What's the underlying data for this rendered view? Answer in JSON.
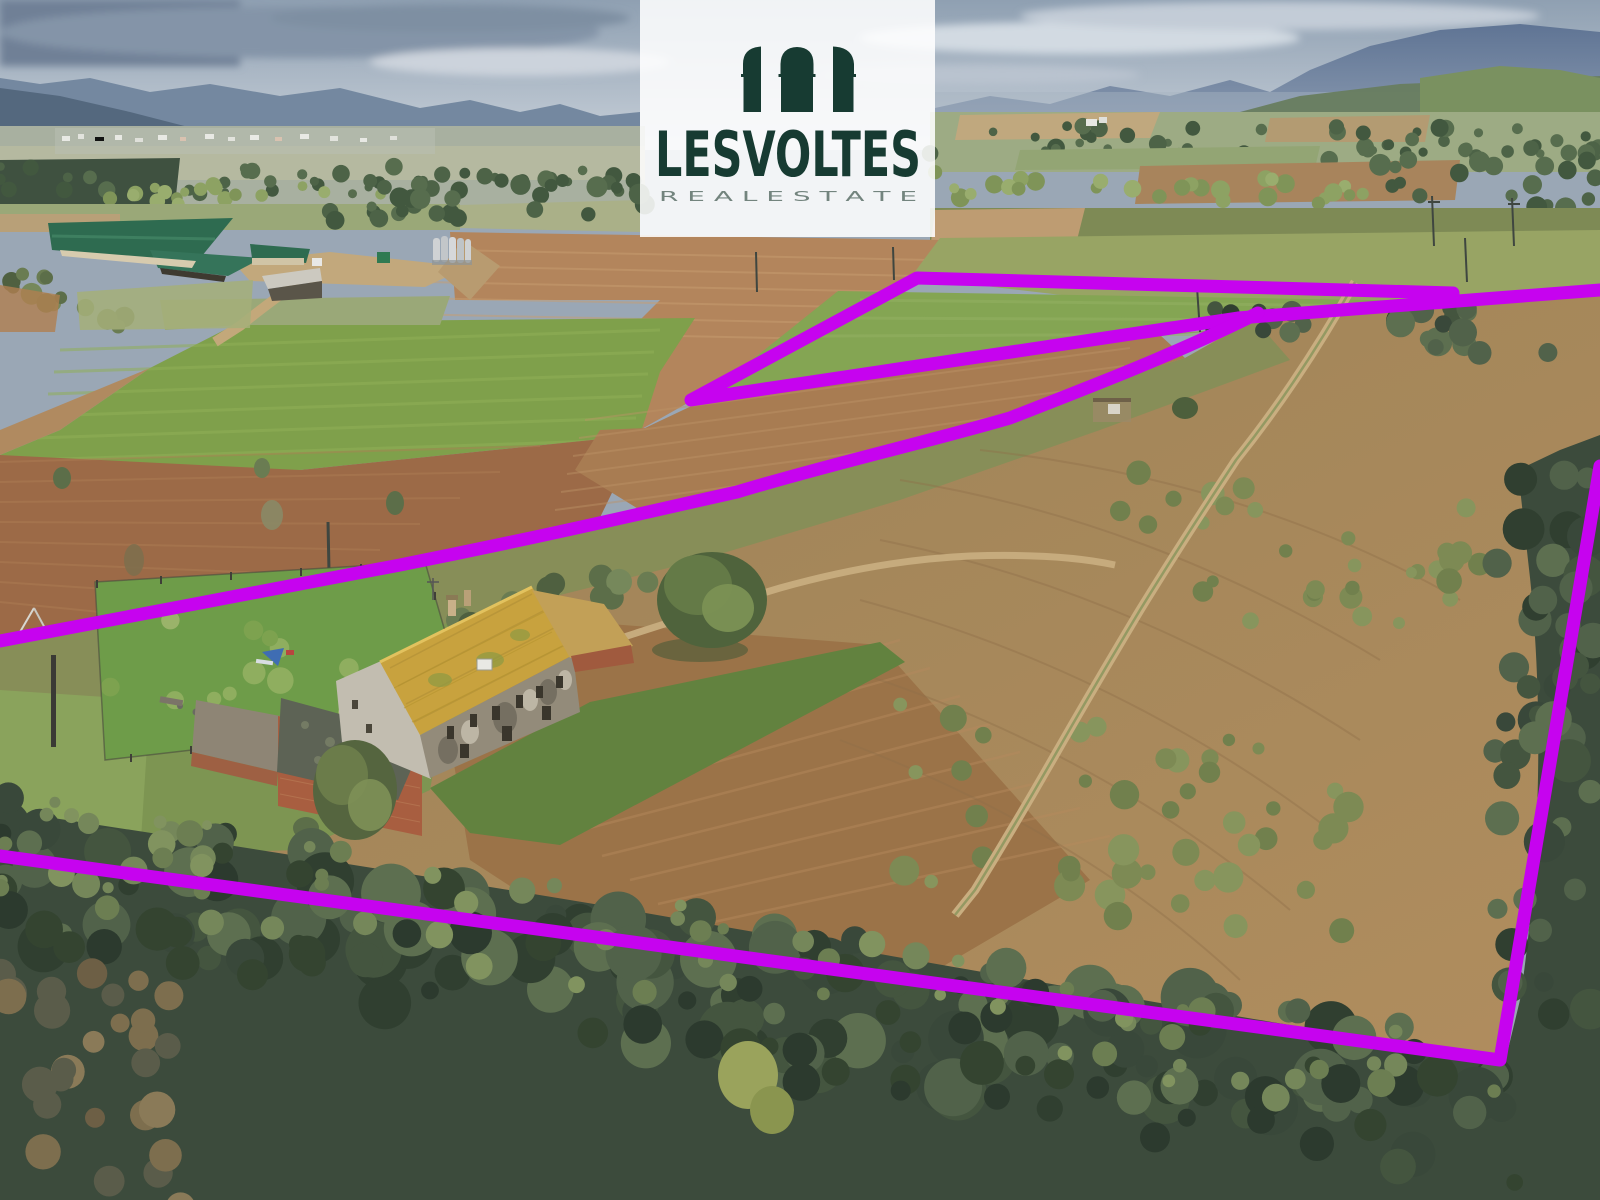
{
  "logo": {
    "title": "LESVOLTES",
    "subtitle": "R E A L   E S T A T E",
    "brand_color": "#173B32",
    "subtitle_color": "#73847E"
  },
  "boundary": {
    "color": "#C603EF",
    "stroke_width": "13"
  }
}
